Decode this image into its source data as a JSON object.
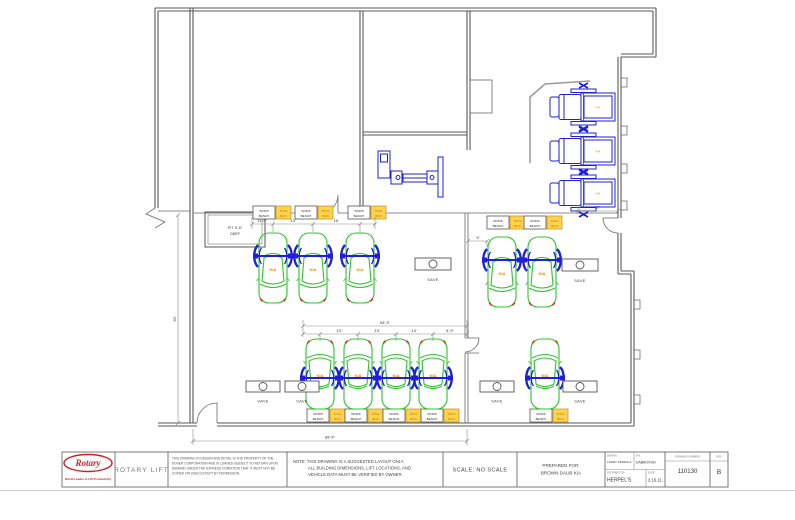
{
  "sheet": {
    "plan": {
      "pit_line1": "PIT, 5'-6\"",
      "pit_line2": "DEEP",
      "bench_l1": "WORK",
      "bench_l2": "BENCH",
      "toolbox_l1": "TOOL",
      "toolbox_l2": "BOX",
      "save": "SAVE",
      "car_badge": "KIA",
      "dims": {
        "bay1": "11'-9\"",
        "bay2": "13'",
        "bay3": "16'",
        "total_mid": "53'-3\"",
        "b1": "13'",
        "b2": "13'",
        "b3": "13'",
        "b4": "9'-9\"",
        "offset": "6'",
        "truck_bay": "10'",
        "depth": "60'",
        "width": "89'-4\""
      }
    },
    "title_block": {
      "brand": "Rotary",
      "brand_tagline": "World Leader in Lift Productivity",
      "company": "ROTARY LIFT",
      "property_lines": [
        "THIS DRAWING IN DESIGN AND DETAIL IS THE PROPERTY OF THE",
        "DOVER CORPORATION AND IS LOANED SUBJECT TO RETURN UPON",
        "DEMAND UNDER THE EXPRESS CONDITION THAT IT MUST NOT BE",
        "COPIED OR USED EXCEPT BY PERMISSION."
      ],
      "note_lines": [
        "NOTE:  THIS DRAWING IS A SUGGESTED LAYOUT ONLY.",
        "ALL BUILDING DIMENSIONS, LIFT LOCATIONS, AND",
        "VEHICLE DATA MUST BE VERIFIED BY OWNER."
      ],
      "scale": "SCALE: NO SCALE",
      "prepared_for_label": "PREPARED FOR:",
      "prepared_for": "BROWN DAUB KIA",
      "drawn_label": "DRAWN",
      "drawn": "LARRY KENDALL",
      "pn_label": "P.N.",
      "pn": "DABROVSKI",
      "distributor_label": "DISTRIBUTOR",
      "distributor": "HERPEL'S",
      "date_label": "DATE",
      "date": "2.16.11",
      "drawing_number_label": "DRAWING NUMBER",
      "drawing_number": "110130",
      "rev_label": "REV",
      "rev": "B"
    }
  }
}
